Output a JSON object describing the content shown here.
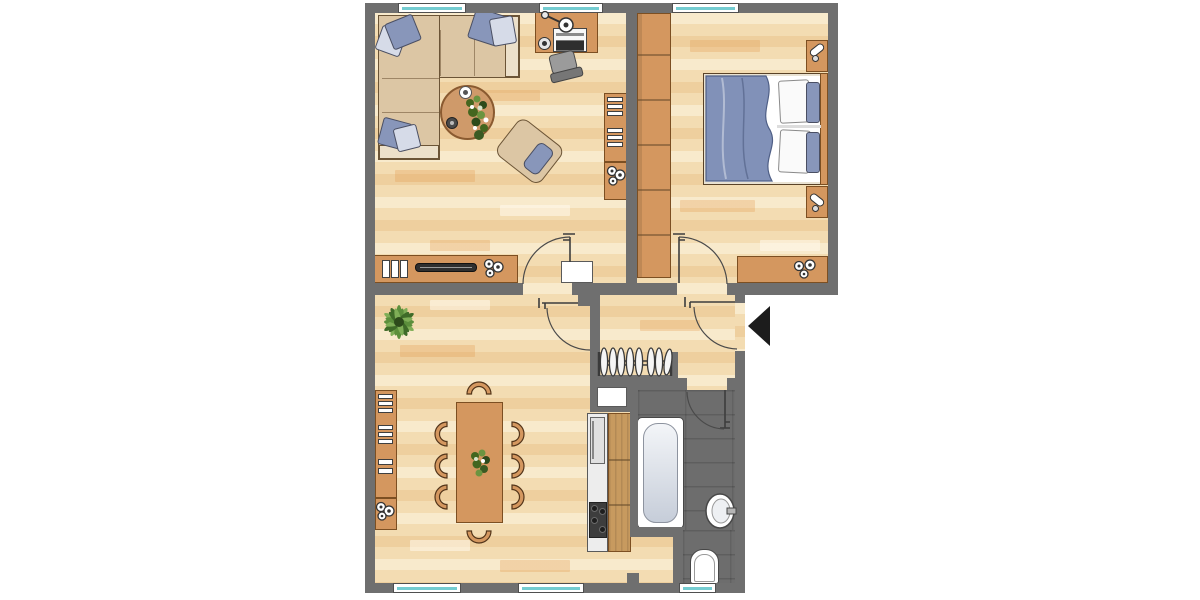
{
  "title": "apartment-floor-plan",
  "colors": {
    "wall": "#6f6f6f",
    "furniture": "#d4975f",
    "furniture_line": "#7c4f22",
    "wood": "#c79a5f",
    "sofa": "#dcc6a4",
    "sofa_line": "#6b5436",
    "pillow_blue": "#8896ba",
    "pillow_light": "#d6dbe8",
    "blanket": "#8191b8",
    "floor": "#f3dcb2",
    "bath_floor": "#6d6d6d",
    "white": "#ffffff",
    "teal": "#74ccd1",
    "appliance": "#ededed",
    "stove": "#3d3d3d",
    "chair_gray": "#979797",
    "plant": "#5c8f3c",
    "plant_dark": "#2d4a1b",
    "arrow": "#1c1c1c"
  },
  "plan": {
    "rooms": [
      {
        "id": "living-room",
        "furniture": [
          "corner-sofa",
          "coffee-table",
          "armchair",
          "desk",
          "office-chair",
          "desk-lamp",
          "laptop",
          "bookshelf",
          "plant-cabinet",
          "lowboard",
          "radiator-niche"
        ]
      },
      {
        "id": "bedroom",
        "furniture": [
          "wardrobe",
          "double-bed",
          "nightstand-top",
          "nightstand-bottom",
          "dresser"
        ],
        "wardrobe_sections": 6
      },
      {
        "id": "dining-room",
        "furniture": [
          "dining-table",
          "chairs",
          "wall-shelf",
          "cabinet",
          "floor-plant"
        ],
        "chair_count": 8
      },
      {
        "id": "kitchen",
        "furniture": [
          "fridge",
          "counter",
          "stove"
        ],
        "stove_burners": 4
      },
      {
        "id": "hallway",
        "furniture": [
          "coat-rack"
        ],
        "hanger_count": 8
      },
      {
        "id": "bathroom",
        "furniture": [
          "bathtub",
          "washbasin",
          "toilet"
        ]
      }
    ],
    "windows": {
      "top": 3,
      "bottom": 3
    },
    "doors": [
      "living-room-door",
      "bedroom-door",
      "dining-room-door",
      "entrance-door",
      "bathroom-door"
    ],
    "entrance_arrow": {
      "direction": "left"
    }
  }
}
